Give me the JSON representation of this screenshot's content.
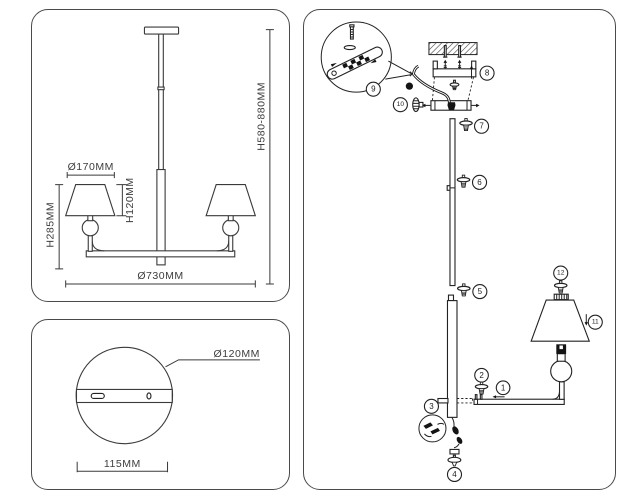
{
  "front_view": {
    "shade_diameter": "Ø170MM",
    "shade_height": "H120MM",
    "body_height": "H285MM",
    "total_width": "Ø730MM",
    "suspension_height": "H580-880MM"
  },
  "canopy_view": {
    "canopy_diameter": "Ø120MM",
    "plate_width": "115MM"
  },
  "assembly_view": {
    "parts": [
      "1",
      "2",
      "3",
      "4",
      "5",
      "6",
      "7",
      "8",
      "9",
      "10",
      "11",
      "12"
    ]
  },
  "colors": {
    "line": "#3a3a3a",
    "panel_border": "#4a4a4a",
    "background": "#ffffff"
  }
}
